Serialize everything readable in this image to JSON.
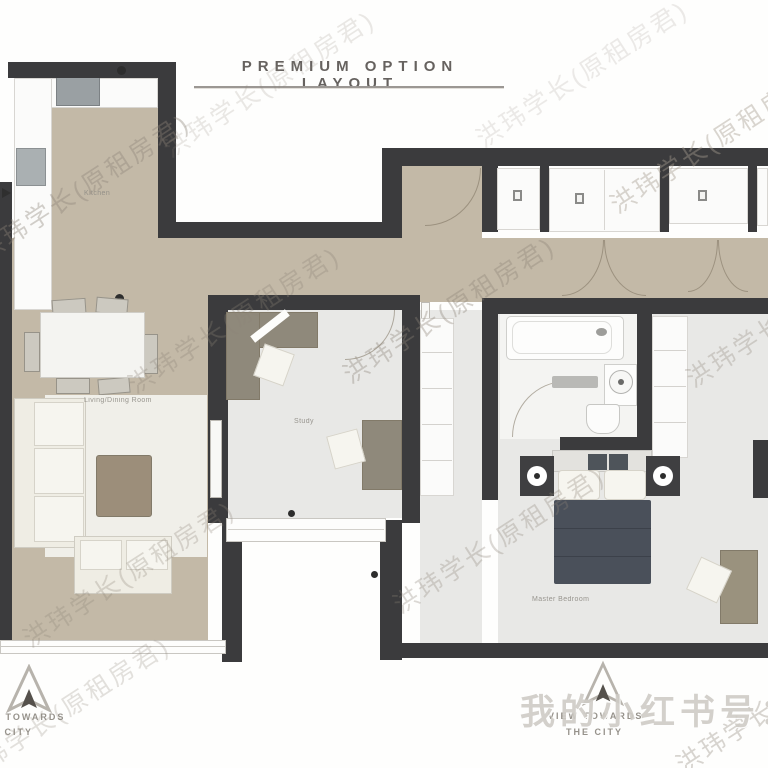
{
  "title": {
    "text": "PREMIUM OPTION LAYOUT"
  },
  "rooms": {
    "kitchen": {
      "label": "Kitchen"
    },
    "living_dining": {
      "label": "Living/Dining Room"
    },
    "study": {
      "label": "Study"
    },
    "master_bedroom": {
      "label": "Master Bedroom"
    }
  },
  "compasses": {
    "left": {
      "line1": "VIEW TOWARDS",
      "line2": "THE CITY"
    },
    "right": {
      "line1": "VIEW TOWARDS",
      "line2": "THE CITY"
    }
  },
  "watermarks": {
    "diagonal_text": "洪玮学长(原租房君)",
    "footer_text": "我的小红书号："
  },
  "icons": {
    "compass": "hollow-triangle-north-arrow",
    "closet_fixtures": [
      "vent",
      "vent",
      "vent"
    ]
  },
  "colors": {
    "wall": "#3b3b3d",
    "floor_tan": "#c3b9a7",
    "floor_gray": "#e8e8e6",
    "floor_bath": "#f4f4f2",
    "furniture_white": "#efede4",
    "furniture_wood": "#978e7c",
    "bed_duvet": "#4a505a",
    "title_text": "#66625f",
    "label_text": "#8f8c85"
  }
}
